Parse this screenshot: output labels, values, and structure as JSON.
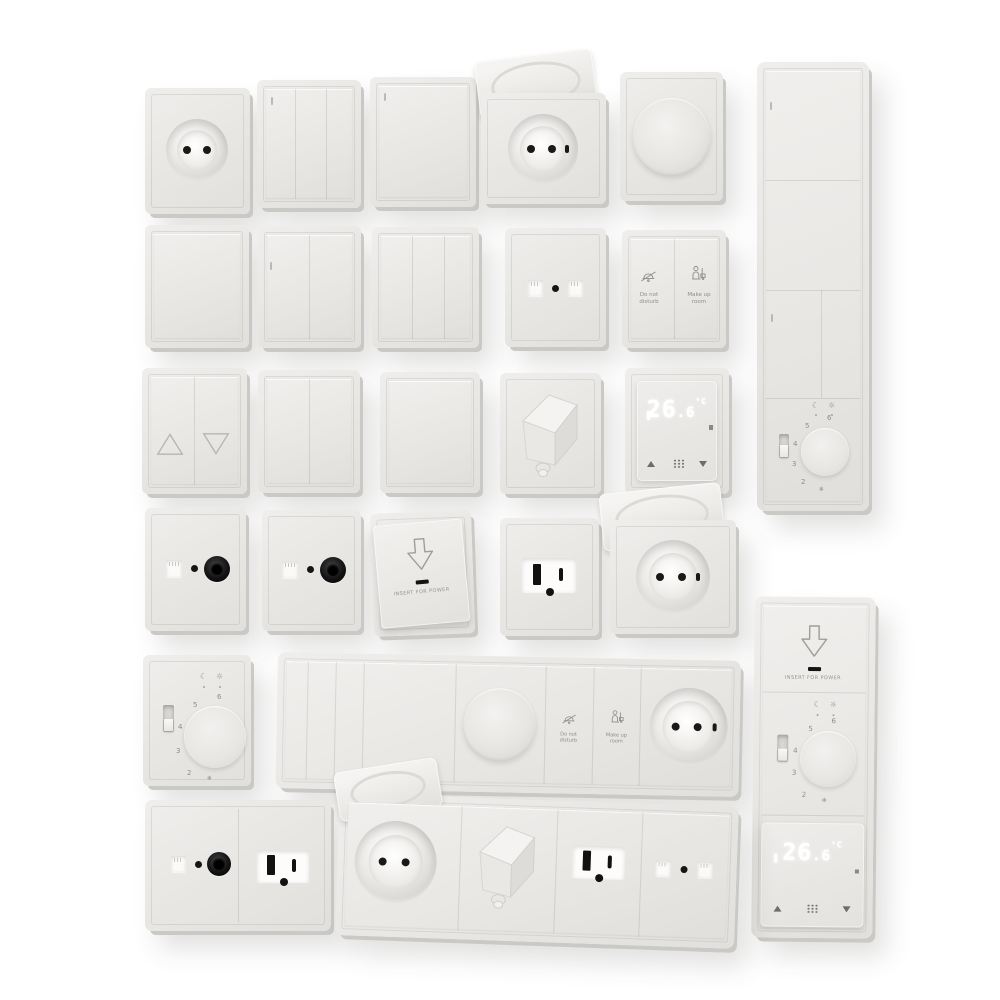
{
  "colors": {
    "background": "#ffffff",
    "plate": "#e9e7e4",
    "plate_edge": "#cbc9c5",
    "dark_parts": "#161615",
    "label_text": "#8f8d88",
    "display_glow": "#ffffff"
  },
  "hotel": {
    "dnd1": "Do not",
    "dnd2": "disturb",
    "mur1": "Make up",
    "mur2": "room"
  },
  "keycard": {
    "label": "INSERT FOR POWER"
  },
  "dt": {
    "integer": "26",
    "decimal": ".6",
    "unit": "°C"
  },
  "at": {
    "n2": "2",
    "n3": "3",
    "n4": "4",
    "n5": "5",
    "n6": "6",
    "frost": "❄",
    "moon": "☾",
    "sun": "☼"
  },
  "fixtures": [
    "euro-socket",
    "3-gang-switch",
    "1-gang-switch",
    "euro-socket-with-lid",
    "rotary-dimmer",
    "vertical-panel-two-switches-2-gang-and-analog-thermostat",
    "blank-switch",
    "2-gang-switch",
    "3-gang-switch",
    "data-socket",
    "hotel-service-switch",
    "blinds-switch",
    "2-gang-switch",
    "blank-switch",
    "angled-cable-outlet",
    "digital-thermostat-26.6C",
    "tv-socket",
    "tv-socket",
    "keycard-power-holder",
    "us-outlet",
    "euro-socket-with-lid",
    "analog-dial-thermostat",
    "horizontal-panel-switches-dimmer-hotel-buttons-euro-socket",
    "double-plate-tv-and-us-outlet",
    "horizontal-panel-lid-socket-angled-outlet-us-outlet-data-socket",
    "vertical-panel-keycard-analog-thermostat-digital-thermostat"
  ]
}
